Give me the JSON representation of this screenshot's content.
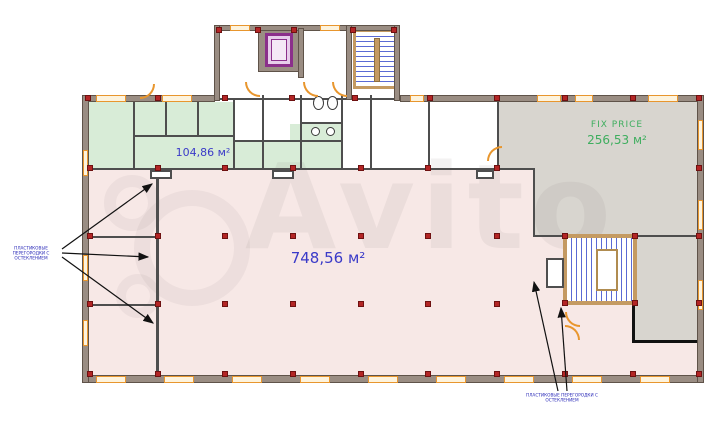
{
  "plan": {
    "title": "floor-plan",
    "watermark_text": "Avito",
    "zones": {
      "open_space": {
        "area_label": "748,56 м²",
        "fill": "#f7e8e6",
        "label_color": "#3a3ac8"
      },
      "green_zone": {
        "area_label": "104,86 м²",
        "fill": "#d8ecd7",
        "label_color": "#3a3ac8"
      },
      "fix_price": {
        "name": "FIX PRICE",
        "area_label": "256,53 м²",
        "fill": "#d8d5cf",
        "label_color": "#3fae5f"
      }
    },
    "annotations": {
      "left": {
        "line1": "ПЛАСТИКОВЫЕ ПЕРЕГОРОДКИ С",
        "line2": "ОСТЕКЛЕНИЕМ"
      },
      "bottom": {
        "line1": "ПЛАСТИКОВЫЕ ПЕРЕГОРОДКИ С",
        "line2": "ОСТЕКЛЕНИЕМ"
      }
    },
    "legend_colors": {
      "wall": "#9a8d83",
      "column_marker": "#b32525",
      "stairs_blue": "#5a6ad4",
      "window_orange": "#e8962e",
      "elevator_purple": "#8b2f8b",
      "area_label_blue": "#3a3ac8",
      "fix_price_green": "#3fae5f"
    }
  }
}
